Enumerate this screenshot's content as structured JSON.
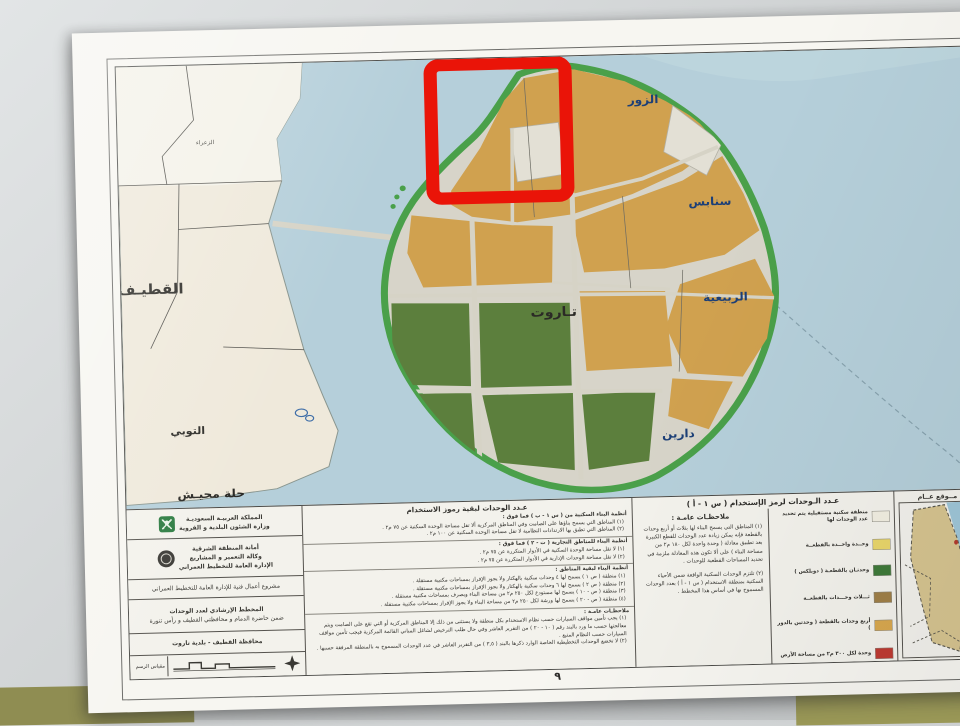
{
  "photo": {
    "background_color": "#d3d6d7",
    "table_color": "#8f8d52",
    "paper_color": "#f7f6f1"
  },
  "map": {
    "colors": {
      "water": "#b5cfda",
      "mainland": "#efe9db",
      "mainland_north": "#f4f2e9",
      "island_base": "#d7d4c9",
      "shoreline_green": "#4aa04a",
      "zone_orange": "#d0a14f",
      "zone_green": "#5c7f3d",
      "road": "#d6d3c6",
      "annotation_red": "#ea1408",
      "town_label_blue": "#1c3f77"
    },
    "labels": {
      "qatif": "القطيـف",
      "altubi": "التوبي",
      "hillat_muhaish": "حلة محيـش",
      "alzara": "الزعراء",
      "alzour": "الزور",
      "sanabis": "سنابس",
      "alrabiyah": "الربيعية",
      "tarout": "تـاروت",
      "darin": "دارين"
    },
    "annotation": {
      "type": "highlight-rectangle",
      "color": "#ea1408",
      "area": "شمال جزيرة تاروت"
    }
  },
  "legend": {
    "title_block": {
      "row1_line1": "المملكة العربيـة السعوديـة",
      "row1_line2": "وزارة الشئون البلدية و القروية",
      "row2_line1": "أمانة المنطقة الشرقية",
      "row2_line2": "وكالة التعمير و المشاريع",
      "row2_line3": "الإدارة العامة للتخطيط العمراني",
      "row3": "مشروع أعمال فنية للإدارة العامة للتخطيط العمراني",
      "row4_line1": "المخطط الإرشادي لعدد الوحدات",
      "row4_line2": "ضمن حاضرة الدمام و محافظتي القطيف و رأس تنورة",
      "row5": "محافظة القطيف - بلدية تاروت",
      "scale_label": "مقياس الرسم"
    },
    "other_codes": {
      "title": "عـدد الوحدات لبقية رموز الاستخدام",
      "sections": [
        {
          "heading": "أنظمة البناء السكنية من ( س ١ - ب ) فما فوق :",
          "items": [
            "(١) المناطق التي يسمح بناؤها على الصامت وفي المناطق المركزية ألا تقل مساحة الوحدة السكنية عن ٧٥ م٢ .",
            "(٢) المناطق التي تطبق بها الارتدادات النظامية لا تقل مساحة الوحدة السكنية عن ١٠٠ م٢ ."
          ]
        },
        {
          "heading": "أنظمة البناء للمناطق التجارية ( ت - ٢ ) فما فوق :",
          "items": [
            "(١) لا تقل مساحة الوحدة السكنية في الأدوار المتكررة عن ٧٥ م٢ .",
            "(٢) لا تقل مساحة الوحدات الإدارية في الأدوار المتكررة عن ٧٥ م٢ ."
          ]
        },
        {
          "heading": "أنظمة البناء لبقية المناطق :",
          "items": [
            "(١) منطقة ( ص ١ ) يسمح لها ٤ وحدات سكنية بالهكتار ولا يجوز الإفراز بمساحات مكتبية مستقلة .",
            "(٢) منطقة ( ص ٢ ) يسمح لها ٦ وحدات سكنية بالهكتار ولا يجوز الإفراز بمساحات مكتبية مستقلة .",
            "(٣) منطقة ( ص - ١٠ ) يسمح لها مستودع لكل ٢٥٠ م٢ من مساحة البناء ويصرف بمساحات مكتبية مستقلة .",
            "(٤) منطقة ( ص - ٢٠ ) يسمح لها ورشة لكل ٢٥٠ م٢ من مساحة البناء ولا يجوز الإفراز بمساحات مكتبية مستقلة ."
          ]
        },
        {
          "heading": "ملاحظـات عامـة :",
          "items": [
            "(١) يجب تأمين مواقف السيارات حسب نظام الاستخدام بكل منطقة ولا يستثنى من ذلك إلا المناطق المركزية أو التي تقع على الصامت ويتم معالجتها حسب ما ورد بالبند رقم ( ١٠ - ٢٠ ) من التقرير العاشر وفي حال طلب الترخيص لشاغل المباني القائمة المركزية فيجب تأمين مواقف السيارات حسب النظام المتبع .",
            "(٢) لا تخضع الوحدات التخطيطية الخاصة الوارد ذكرها بالبند ( ٣,٥ ) من التقرير العاشر في عدد الوحدات المسموح به بالمنطقة المرفقة حسبها ."
          ]
        }
      ]
    },
    "code_s1a": {
      "title": "عـدد الـوحدات لرمز الإستخدام ( س ١ - أ )",
      "notes_title": "ملاحظـات عامـة :",
      "note1": "(١) المناطق التي يسمح البناء لها بثلاث أو أربع وحدات بالقطعة فإنه يمكن زيادة عدد الوحدات للقطع الكبيرة بعد تطبيق معادلة ( وحدة واحدة لكل ١٨٠ م٢ من مساحة البناء ) على ألا تكون هذه المعادلة ملزمة في تحديد المساحات القطعية للوحدات .",
      "note2": "(٢) تلتزم الوحدات السكنية الواقعة ضمن الأحياء السكنية بمنطقة الاستخدام ( س ١ - أ ) بعدد الوحدات المسموح بها في أساس هذا المخطط .",
      "entries": [
        {
          "label": "منطقة سكنية مستقبلية يتم تحديد عدد الوحدات لها",
          "color": "#f2efe2"
        },
        {
          "label": "وحــدة واحــدة بالقطعــة",
          "color": "#e9d66b"
        },
        {
          "label": "وحدتـان بالقطعـة ( دوبلكس )",
          "color": "#3f7a3a"
        },
        {
          "label": "ثـــلاث وحـــدات بالقطعــة",
          "color": "#a08048"
        },
        {
          "label": "أربع وحدات بالقطعة ( وحدتين بالدور )",
          "color": "#d8a84f"
        },
        {
          "label": "وحدة لكل ٣٠٠ م٢ من مساحة الأرض",
          "color": "#bf3a32"
        }
      ]
    },
    "inset": {
      "title": "مــوقع عــام"
    },
    "page_number": "٩"
  }
}
